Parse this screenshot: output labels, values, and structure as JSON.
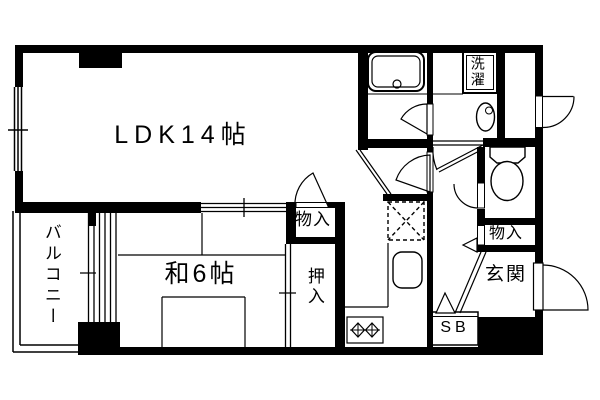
{
  "floorplan": {
    "labels": {
      "ldk": "LDK14帖",
      "washitsu": "和6帖",
      "balcony": "バルコニー",
      "storage_ldk": "物入",
      "oshiire": "押入",
      "storage_hall": "物入",
      "genkan": "玄関",
      "laundry": "洗濯",
      "shoe_box": "SB"
    },
    "rooms": [
      {
        "name": "living-dining-kitchen",
        "label": "LDK14帖",
        "size_tatami": 14
      },
      {
        "name": "japanese-room",
        "label": "和6帖",
        "size_tatami": 6
      },
      {
        "name": "balcony",
        "label": "バルコニー"
      },
      {
        "name": "storage-near-ldk",
        "label": "物入"
      },
      {
        "name": "closet-oshiire",
        "label": "押入"
      },
      {
        "name": "storage-near-entry",
        "label": "物入"
      },
      {
        "name": "entrance",
        "label": "玄関"
      },
      {
        "name": "laundry-space",
        "label": "洗濯"
      },
      {
        "name": "shoe-box",
        "label": "SB"
      }
    ],
    "fixtures": [
      "bathtub",
      "bathtub-drain",
      "washing-machine-space",
      "vanity-basin",
      "toilet",
      "refrigerator-space",
      "kitchen-sink",
      "gas-stove-2-burner"
    ],
    "features": [
      "balcony-sliding-window",
      "ldk-window",
      "fusuma-sliding-doors",
      "entrance-door-outswing",
      "service-door-outswing",
      "bathroom-door",
      "toilet-door",
      "step-markers",
      "genkan-step-line"
    ],
    "colors": {
      "ink": "#000000",
      "paper": "#ffffff"
    }
  }
}
